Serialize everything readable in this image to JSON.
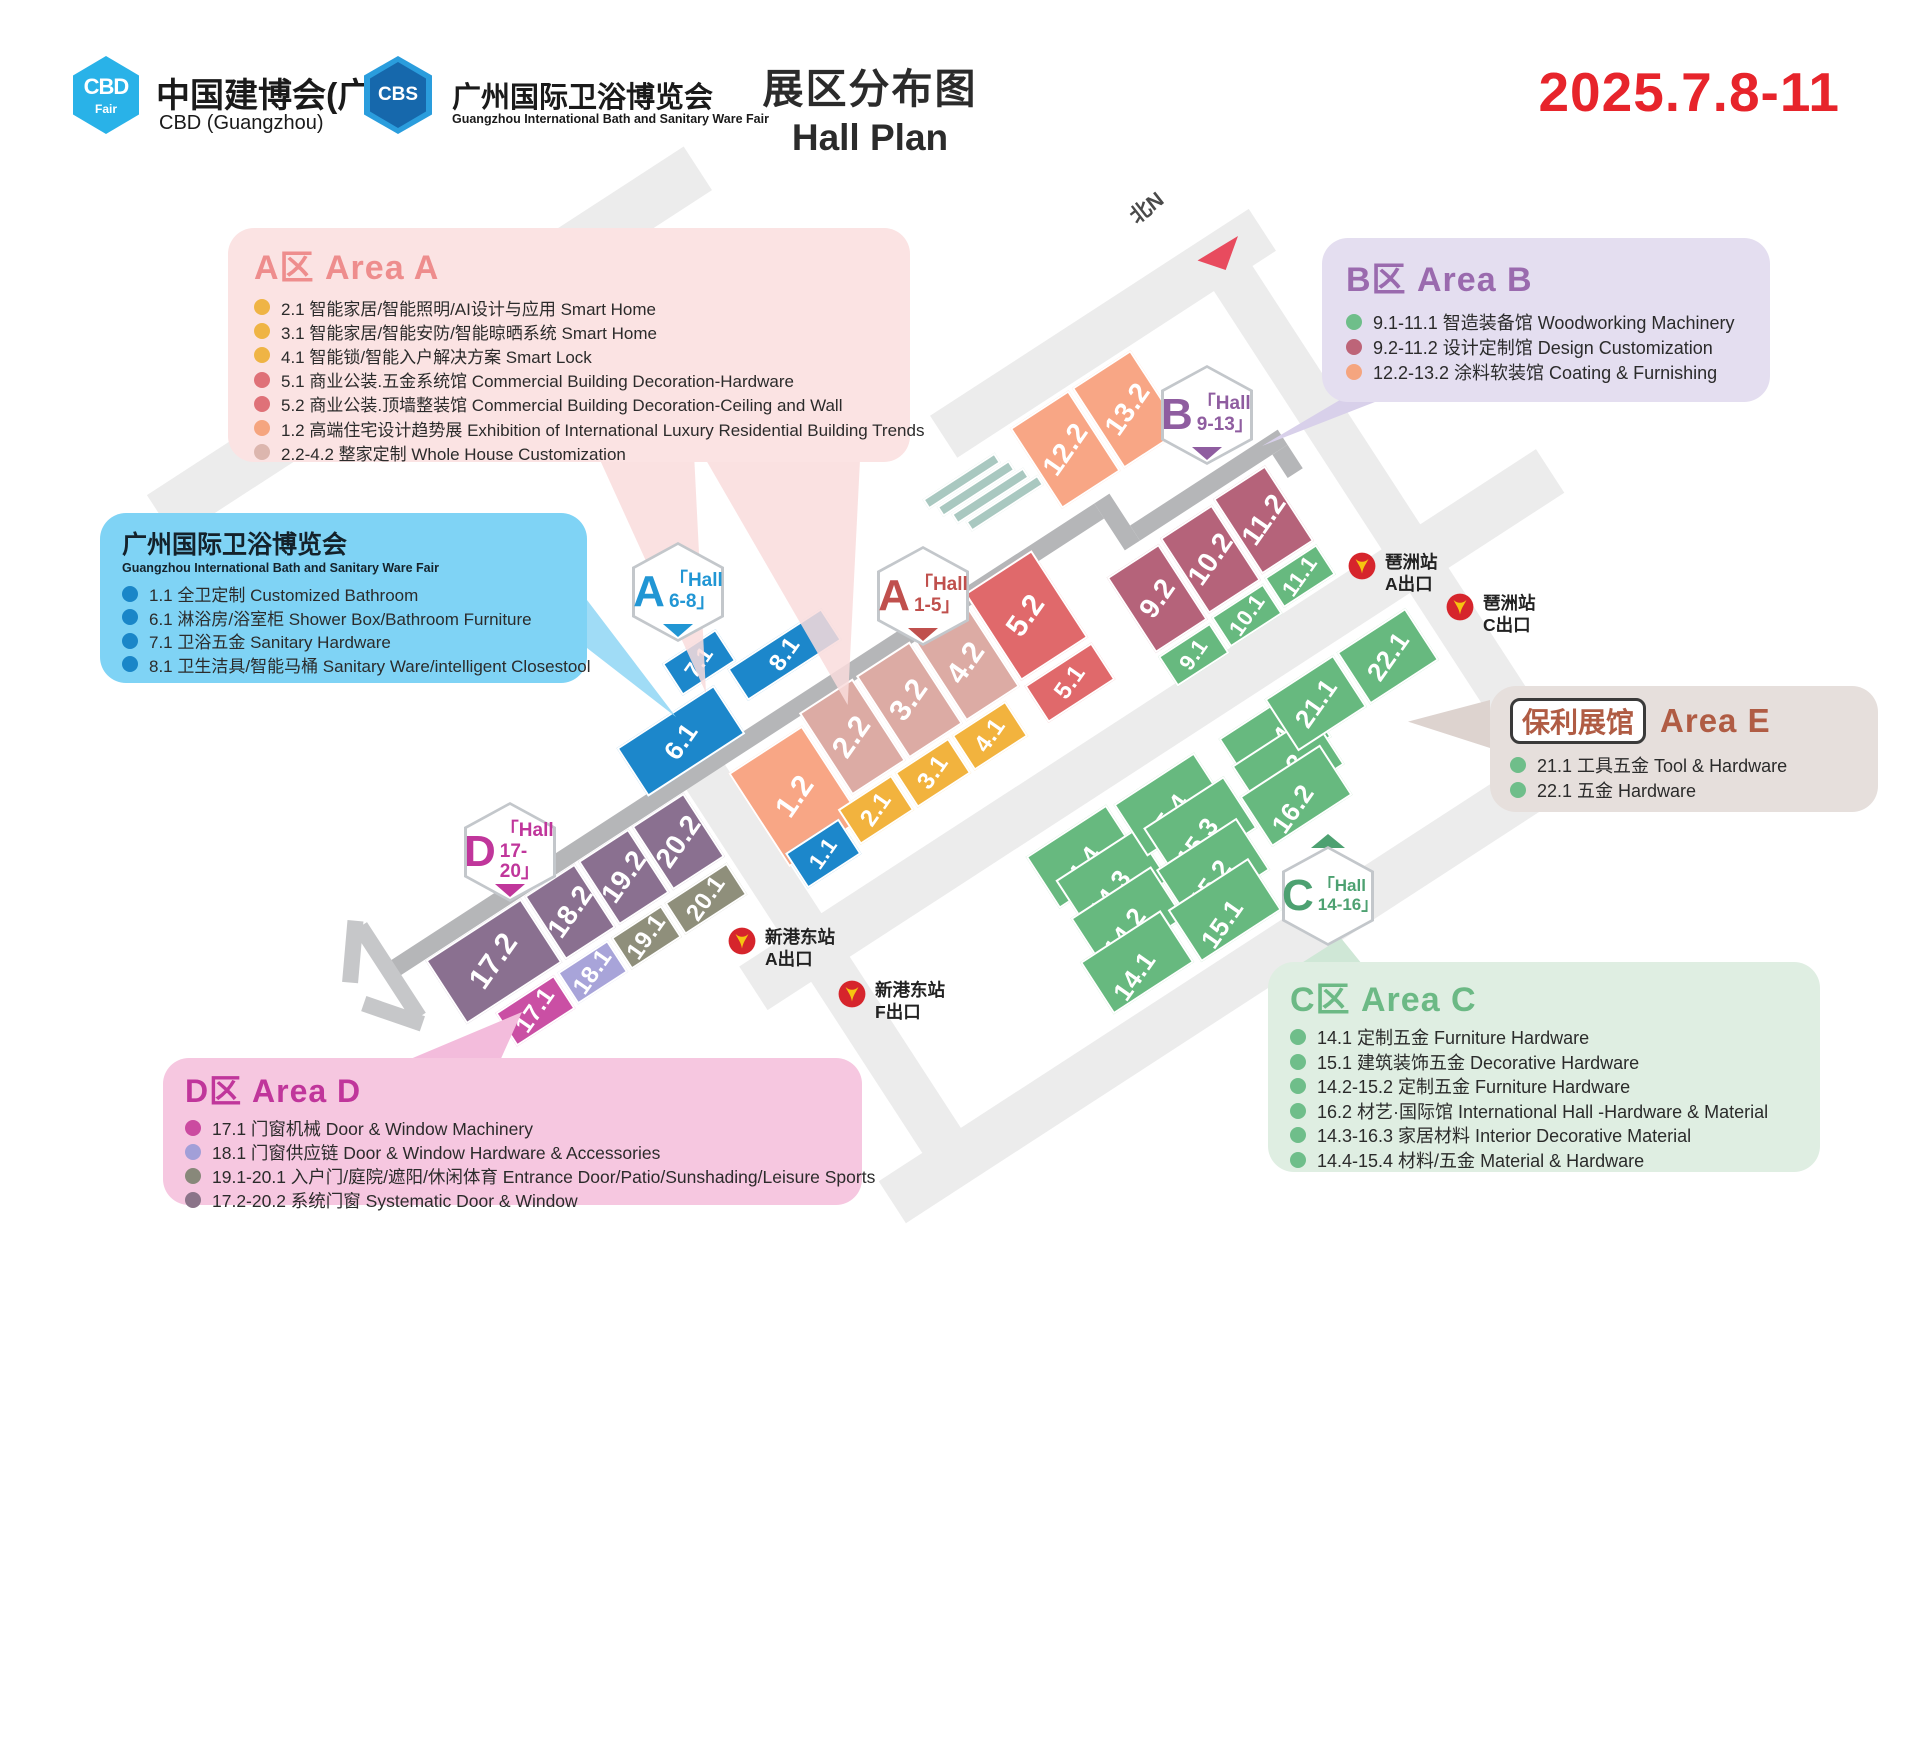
{
  "header": {
    "cbd_logo": {
      "text": "CBD",
      "sub": "Fair"
    },
    "cbd_title": "中国建博会(广州)",
    "cbd_subtitle": "CBD (Guangzhou)",
    "cbs_logo": "CBS",
    "cbs_title": "广州国际卫浴博览会",
    "cbs_subtitle": "Guangzhou International Bath and Sanitary Ware Fair",
    "title_zh": "展区分布图",
    "title_en": "Hall Plan",
    "date": "2025.7.8-11"
  },
  "legends": {
    "area_a": {
      "title": "A区 Area A",
      "items": [
        {
          "label": "2.1 智能家居/智能照明/AI设计与应用 Smart Home",
          "color": "#efb445"
        },
        {
          "label": "3.1 智能家居/智能安防/智能晾晒系统 Smart Home",
          "color": "#efb445"
        },
        {
          "label": "4.1 智能锁/智能入户解决方案 Smart Lock",
          "color": "#efb445"
        },
        {
          "label": "5.1 商业公装.五金系统馆 Commercial Building Decoration-Hardware",
          "color": "#df7178"
        },
        {
          "label": "5.2 商业公装.顶墙整装馆 Commercial Building Decoration-Ceiling and Wall",
          "color": "#df7178"
        },
        {
          "label": "1.2 高端住宅设计趋势展 Exhibition of International Luxury Residential Building Trends",
          "color": "#f5a57f"
        },
        {
          "label": "2.2-4.2 整家定制 Whole House Customization",
          "color": "#dcb6ae"
        }
      ]
    },
    "bath_fair": {
      "title": "广州国际卫浴博览会",
      "subtitle": "Guangzhou International Bath and Sanitary Ware Fair",
      "items": [
        {
          "label": "1.1 全卫定制 Customized Bathroom",
          "color": "#1a86c8"
        },
        {
          "label": "6.1 淋浴房/浴室柜 Shower Box/Bathroom Furniture",
          "color": "#1a86c8"
        },
        {
          "label": "7.1 卫浴五金 Sanitary Hardware",
          "color": "#1a86c8"
        },
        {
          "label": "8.1 卫生洁具/智能马桶 Sanitary Ware/intelligent Closestool",
          "color": "#1a86c8"
        }
      ]
    },
    "area_b": {
      "title": "B区 Area B",
      "items": [
        {
          "label": "9.1-11.1 智造装备馆 Woodworking Machinery",
          "color": "#6fbe8a"
        },
        {
          "label": "9.2-11.2 设计定制馆 Design Customization",
          "color": "#bd6478"
        },
        {
          "label": "12.2-13.2 涂料软装馆 Coating & Furnishing",
          "color": "#f5a57f"
        }
      ]
    },
    "area_e": {
      "badge": "保利展馆",
      "title": "Area E",
      "items": [
        {
          "label": "21.1 工具五金 Tool & Hardware",
          "color": "#6fbe8a"
        },
        {
          "label": "22.1 五金 Hardware",
          "color": "#6fbe8a"
        }
      ]
    },
    "area_c": {
      "title": "C区 Area C",
      "items": [
        {
          "label": "14.1 定制五金 Furniture Hardware",
          "color": "#6fbe8a"
        },
        {
          "label": "15.1 建筑装饰五金 Decorative Hardware",
          "color": "#6fbe8a"
        },
        {
          "label": "14.2-15.2 定制五金 Furniture Hardware",
          "color": "#6fbe8a"
        },
        {
          "label": "16.2 材艺·国际馆 International Hall -Hardware & Material",
          "color": "#6fbe8a"
        },
        {
          "label": "14.3-16.3 家居材料 Interior Decorative Material",
          "color": "#6fbe8a"
        },
        {
          "label": "14.4-15.4 材料/五金 Material & Hardware",
          "color": "#6fbe8a"
        }
      ]
    },
    "area_d": {
      "title": "D区 Area D",
      "items": [
        {
          "label": "17.1 门窗机械  Door & Window Machinery",
          "color": "#cb4ba0"
        },
        {
          "label": "18.1 门窗供应链  Door & Window Hardware & Accessories",
          "color": "#a29fd8"
        },
        {
          "label": "19.1-20.1 入户门/庭院/遮阳/休闲体育 Entrance Door/Patio/Sunshading/Leisure Sports",
          "color": "#88887a"
        },
        {
          "label": "17.2-20.2 系统门窗 Systematic Door & Window",
          "color": "#8b7489"
        }
      ]
    }
  },
  "map": {
    "compass": "北N",
    "landmark": {
      "line1": "国际",
      "line2": "会议中心"
    },
    "badges": {
      "a68": {
        "letter": "A",
        "line1": "「Hall",
        "line2": "6-8」",
        "color": "#2196d4"
      },
      "a15": {
        "letter": "A",
        "line1": "「Hall",
        "line2": "1-5」",
        "color": "#c0504d"
      },
      "b913": {
        "letter": "B",
        "line1": "「Hall",
        "line2": "9-13」",
        "color": "#8f5da0"
      },
      "c1416": {
        "letter": "C",
        "line1": "「Hall",
        "line2": "14-16」",
        "color": "#4da171"
      },
      "d1720": {
        "letter": "D",
        "line1": "「Hall",
        "line2": "17-20」",
        "color": "#c0369b"
      }
    },
    "halls": {
      "h1_1": "1.1",
      "h2_1": "2.1",
      "h3_1": "3.1",
      "h4_1": "4.1",
      "h5_1": "5.1",
      "h1_2": "1.2",
      "h2_2": "2.2",
      "h3_2": "3.2",
      "h4_2": "4.2",
      "h5_2": "5.2",
      "h6_1": "6.1",
      "h7_1": "7.1",
      "h8_1": "8.1",
      "h9_1": "9.1",
      "h10_1": "10.1",
      "h11_1": "11.1",
      "h9_2": "9.2",
      "h10_2": "10.2",
      "h11_2": "11.2",
      "h12_2": "12.2",
      "h13_2": "13.2",
      "h14_1": "14.1",
      "h14_2": "14.2",
      "h14_3": "14.3",
      "h14_4": "14.4",
      "h15_1": "15.1",
      "h15_2": "15.2",
      "h15_3": "15.3",
      "h15_4": "15.4",
      "h16_2": "16.2",
      "h16_3": "16.3",
      "h16_4": "16.4",
      "h17_1": "17.1",
      "h18_1": "18.1",
      "h19_1": "19.1",
      "h20_1": "20.1",
      "h17_2": "17.2",
      "h18_2": "18.2",
      "h19_2": "19.2",
      "h20_2": "20.2",
      "h21_1": "21.1",
      "h22_1": "22.1"
    },
    "stations": [
      {
        "name": "琶洲站",
        "exit": "A出口"
      },
      {
        "name": "琶洲站",
        "exit": "C出口"
      },
      {
        "name": "新港东站",
        "exit": "A出口"
      },
      {
        "name": "新港东站",
        "exit": "F出口"
      }
    ]
  }
}
